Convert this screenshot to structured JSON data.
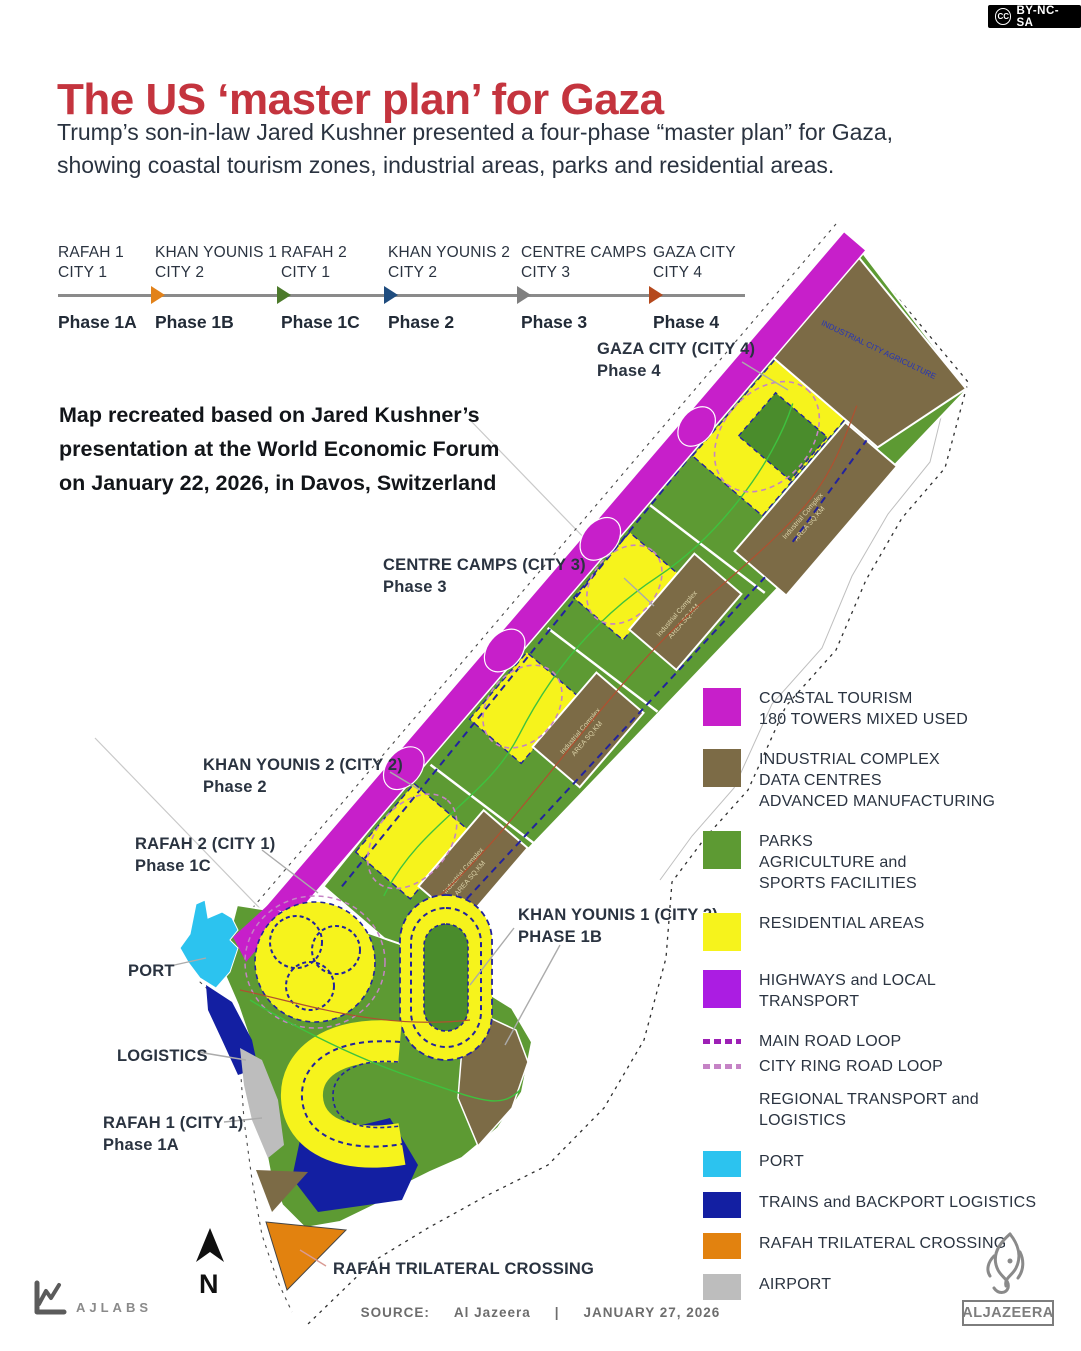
{
  "colors": {
    "title_red": "#c4343e",
    "text_dark": "#2a3340",
    "coastal": "#c71fca",
    "industrial": "#7c6b46",
    "parks": "#5d9a33",
    "park_inner": "#4a8c2c",
    "residential": "#f6f31c",
    "highways": "#ab1de2",
    "main_road": "#9d20b5",
    "ring_road": "#c583c5",
    "port": "#2cc3ef",
    "trains": "#131fa2",
    "crossing": "#e2820f",
    "airport": "#bdbdbd",
    "road_navy": "#22229e",
    "line_gray": "#8a8a8a"
  },
  "badge": {
    "cc_label": "CC",
    "license": "BY-NC-SA"
  },
  "header": {
    "title": "The US ‘master plan’ for Gaza",
    "subtitle_lines": "Trump’s son-in-law Jared Kushner presented a four-phase “master plan” for Gaza,\nshowing coastal tourism zones, industrial areas, parks and residential areas."
  },
  "timeline": {
    "phases": [
      {
        "city_line1": "RAFAH 1",
        "city_line2": "CITY 1",
        "phase": "Phase 1A",
        "arrow_color": null
      },
      {
        "city_line1": "KHAN YOUNIS 1",
        "city_line2": "CITY 2",
        "phase": "Phase 1B",
        "arrow_color": "#e2821a"
      },
      {
        "city_line1": "RAFAH 2",
        "city_line2": "CITY 1",
        "phase": "Phase 1C",
        "arrow_color": "#4c7a2b"
      },
      {
        "city_line1": "KHAN YOUNIS 2",
        "city_line2": "CITY 2",
        "phase": "Phase 2",
        "arrow_color": "#1f4c7e"
      },
      {
        "city_line1": "CENTRE CAMPS",
        "city_line2": "CITY 3",
        "phase": "Phase 3",
        "arrow_color": "#7f7f7f"
      },
      {
        "city_line1": "GAZA CITY",
        "city_line2": "CITY 4",
        "phase": "Phase 4",
        "arrow_color": "#b5491d"
      }
    ]
  },
  "map_note": "Map recreated based on Jared Kushner’s\npresentation at the World Economic Forum\non January 22, 2026, in Davos, Switzerland",
  "map": {
    "compass": "N",
    "industrial_parcel_label": "Industrial Complex",
    "industrial_parcel_sub": "AREA SQ.KM",
    "ne_parcel_label": "INDUSTRIAL CITY AGRICULTURE",
    "labels": [
      {
        "x": 597,
        "y": 338,
        "lines": [
          "GAZA CITY (CITY 4)",
          "Phase 4"
        ]
      },
      {
        "x": 383,
        "y": 554,
        "lines": [
          "CENTRE CAMPS (CITY 3)",
          "Phase 3"
        ]
      },
      {
        "x": 203,
        "y": 754,
        "lines": [
          "KHAN YOUNIS 2 (CITY 2)",
          "Phase 2"
        ]
      },
      {
        "x": 135,
        "y": 833,
        "lines": [
          "RAFAH 2 (CITY 1)",
          "Phase 1C"
        ]
      },
      {
        "x": 128,
        "y": 960,
        "lines": [
          "PORT"
        ]
      },
      {
        "x": 117,
        "y": 1045,
        "lines": [
          "LOGISTICS"
        ]
      },
      {
        "x": 103,
        "y": 1112,
        "lines": [
          "RAFAH 1 (CITY 1)",
          "Phase 1A"
        ]
      },
      {
        "x": 518,
        "y": 904,
        "lines": [
          "KHAN YOUNIS 1 (CITY 2)",
          "PHASE 1B"
        ]
      },
      {
        "x": 333,
        "y": 1258,
        "lines": [
          "RAFAH TRILATERAL CROSSING"
        ]
      }
    ]
  },
  "legend": {
    "items": [
      {
        "type": "swatch",
        "color": "coastal",
        "lines": [
          "COASTAL TOURISM",
          "180 TOWERS MIXED USED"
        ]
      },
      {
        "type": "swatch",
        "color": "industrial",
        "lines": [
          "INDUSTRIAL COMPLEX",
          "DATA CENTRES",
          "ADVANCED MANUFACTURING"
        ]
      },
      {
        "type": "swatch",
        "color": "parks",
        "lines": [
          "PARKS",
          "AGRICULTURE and",
          "SPORTS FACILITIES"
        ]
      },
      {
        "type": "swatch",
        "color": "residential",
        "lines": [
          "RESIDENTIAL AREAS"
        ]
      },
      {
        "type": "swatch",
        "color": "highways",
        "lines": [
          "HIGHWAYS and LOCAL",
          "TRANSPORT"
        ]
      },
      {
        "type": "dash",
        "color": "main_road",
        "lines": [
          "MAIN ROAD LOOP"
        ]
      },
      {
        "type": "dash",
        "color": "ring_road",
        "lines": [
          "CITY RING ROAD LOOP"
        ]
      },
      {
        "type": "text",
        "color": null,
        "lines": [
          "REGIONAL TRANSPORT and LOGISTICS"
        ]
      },
      {
        "type": "swatch-sm",
        "color": "port",
        "lines": [
          "PORT"
        ]
      },
      {
        "type": "swatch-sm",
        "color": "trains",
        "lines": [
          "TRAINS and BACKPORT LOGISTICS"
        ]
      },
      {
        "type": "swatch-sm",
        "color": "crossing",
        "lines": [
          "RAFAH TRILATERAL CROSSING"
        ]
      },
      {
        "type": "swatch-sm",
        "color": "airport",
        "lines": [
          "AIRPORT"
        ]
      }
    ]
  },
  "footer": {
    "ajlabs": "AJLABS",
    "source_label": "SOURCE:",
    "source": "Al Jazeera",
    "divider": "|",
    "date": "JANUARY 27, 2026",
    "brand": "ALJAZEERA"
  }
}
